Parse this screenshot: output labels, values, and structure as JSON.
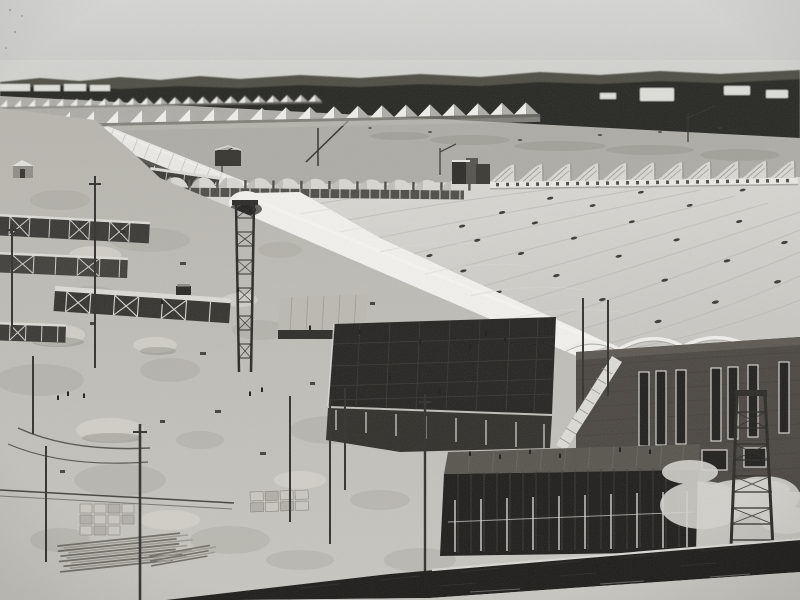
{
  "figure": {
    "kind": "black-and-white aerial photograph",
    "alt": "Elevated view of a vast factory complex under construction: long barrel-vaulted assembly halls with bright white roofs stretch to the right, rows of white sawtooth sheds line the horizon before a dark tree line, a dark brick hall with tall narrow windows stands at the right, and the foreground is filled with scaffolding, dark concrete formwork decks, lattice towers, utility poles, lumber piles and tiny workers on bare dirt, with a dark wall and road band across the bottom."
  },
  "palette": {
    "sky-top": "#d6d6d3",
    "sky-bottom": "#c6c6c3",
    "haze": "#dadad6",
    "trees-far": "#4d4d45",
    "trees": "#262521",
    "horizon-shed": "#deded9",
    "plain": "#adaca6",
    "plain-dark": "#96958e",
    "saw-lit": "#efeeea",
    "saw-shade": "#aeada7",
    "saw-gap": "#76756e",
    "vault-white": "#eae9e5",
    "vault-rib": "#c6c5c0",
    "roof-top": "#dbdad5",
    "roof-bottom": "#c9c8c3",
    "roof-seam": "#b2b1ac",
    "roof-speck": "#3b3a35",
    "bright-vault": "#f2f1ed",
    "eave-shadow": "#3a3934",
    "colonnade": "#393732",
    "post-white": "#e8e7e2",
    "fin": "#d9d8d3",
    "fin-hatch": "#716f68",
    "fin-base": "#e9e8e3",
    "hump": "#d8d7d2",
    "support-dark": "#4f4d47",
    "dirt": "#b7b5ae",
    "dirt-dark": "#9f9d96",
    "mound": "#d2d0c9",
    "deck-dark": "#242320",
    "deck-light": "#bbb9b2",
    "frame-light": "#dcdbd6",
    "frame-dark": "#2d2c28",
    "brick": "#4b4641",
    "brick-light": "#5c5751",
    "window-dark": "#201f1c",
    "window-frame": "#d4d3ce",
    "tower": "#2b2a26",
    "pole": "#32312d",
    "lumber-dark": "#6f6d65",
    "lumber-light": "#9c9a93",
    "crate": "#c9c7c0",
    "wall-dark": "#1c1b18",
    "curb": "#d9d8d3",
    "road": "#c7c6c0",
    "sand": "#d3d2cc",
    "figure-dark": "#1d1c19"
  }
}
